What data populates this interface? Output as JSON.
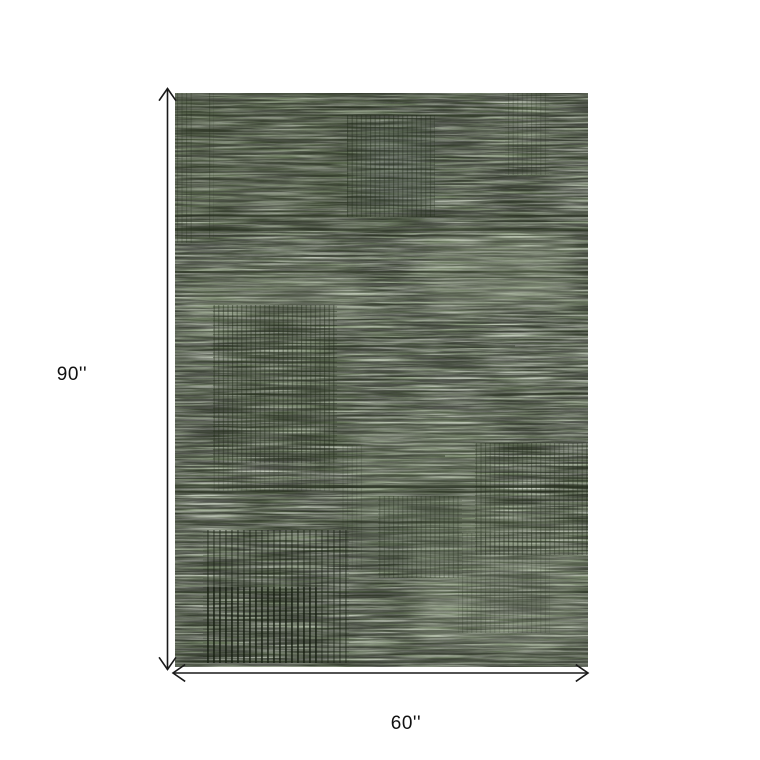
{
  "page": {
    "background": "#ffffff"
  },
  "diagram": {
    "type": "product-dimension-diagram",
    "product_description": "green heathered flatweave rug with dark pinstripe grid blocks",
    "height": {
      "label": "90''"
    },
    "width": {
      "label": "60''"
    },
    "colors": {
      "rug_base": "#7b8c6e",
      "rug_light": "#a7b49a",
      "rug_dark": "#3f4d33",
      "rug_pinstripe": "#202a18",
      "dimension_line": "#1a1a1a",
      "label_text": "#111111"
    }
  }
}
